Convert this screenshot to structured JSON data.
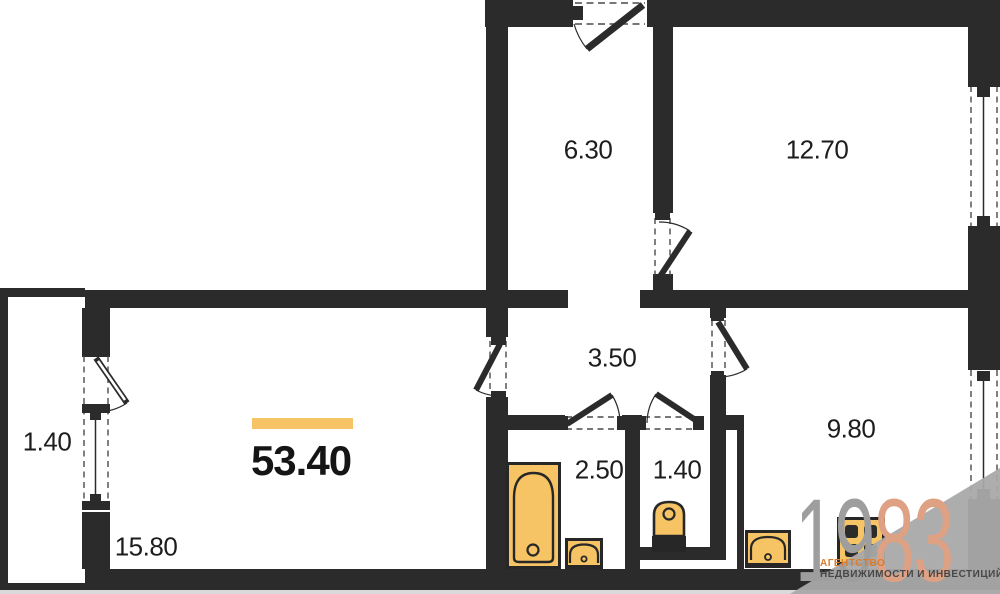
{
  "plan": {
    "title": "apartment-floor-plan",
    "total_area": "53.40",
    "rooms": {
      "hall": {
        "area": "6.30"
      },
      "bedroom": {
        "area": "12.70"
      },
      "corridor": {
        "area": "3.50"
      },
      "balcony": {
        "area": "1.40"
      },
      "living": {
        "area": "15.80"
      },
      "bathroom": {
        "area": "2.50"
      },
      "wc": {
        "area": "1.40"
      },
      "kitchen": {
        "area": "9.80"
      }
    },
    "fixtures": [
      "bathtub",
      "bathroom-sink",
      "toilet",
      "kitchen-sink",
      "stove"
    ]
  },
  "watermark": {
    "digits_gray": "19",
    "digits_accent": "83",
    "line1": "АГЕНТСТВО",
    "line2": "НЕДВИЖИМОСТИ И ИНВЕСТИЦИЙ"
  },
  "colors": {
    "wall": "#2b2b2b",
    "fixture_fill": "#f6c464",
    "accent_bar": "#f6c464",
    "watermark_gray": "#9e9e9e",
    "watermark_accent": "#dfa183",
    "watermark_wedge": "#a9a9a9"
  }
}
